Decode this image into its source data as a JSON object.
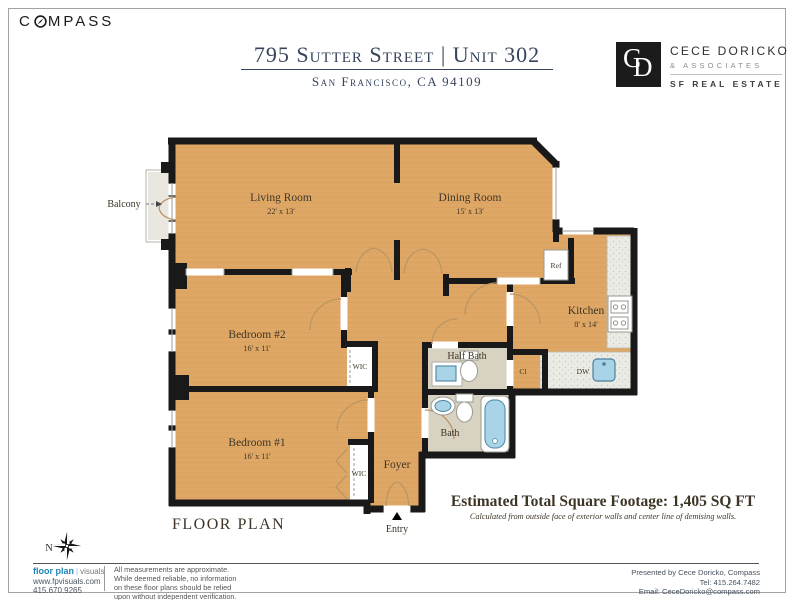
{
  "header": {
    "brand_prefix": "C",
    "brand_suffix": "MPASS",
    "title": "795 Sutter Street  |  Unit 302",
    "subtitle": "San Francisco, CA 94109",
    "agent": {
      "monogram_c": "C",
      "monogram_d": "D",
      "name": "CECE DORICKO",
      "assoc": "& ASSOCIATES",
      "brand": "SF REAL ESTATE"
    }
  },
  "plan": {
    "rooms": [
      {
        "name": "Living Room",
        "dims": "22' x 13'"
      },
      {
        "name": "Dining Room",
        "dims": "15' x 13'"
      },
      {
        "name": "Bedroom #2",
        "dims": "16' x 11'"
      },
      {
        "name": "Bedroom #1",
        "dims": "16' x 11'"
      },
      {
        "name": "Kitchen",
        "dims": "8' x 14'"
      },
      {
        "name": "Half Bath"
      },
      {
        "name": "Bath"
      },
      {
        "name": "Foyer"
      }
    ],
    "features": {
      "wic": "WIC",
      "closet": "Cl",
      "ref": "Ref",
      "dw": "DW",
      "balcony": "Balcony",
      "entry": "Entry",
      "north": "N"
    },
    "caption": "FLOOR PLAN",
    "sqft_line": "Estimated Total Square Footage: 1,405 SQ FT",
    "sqft_note": "Calculated from outside face of exterior walls and center line of demising walls."
  },
  "footer": {
    "fp_logo": {
      "bold": "floor plan",
      "light": "visuals",
      "url": "www.fpvisuals.com",
      "phone": "415.670.9265"
    },
    "disclaimer": [
      "All measurements are approximate.",
      "While deemed reliable, no information",
      "on these floor plans should be relied",
      "upon without independent verification."
    ],
    "presented": [
      "Presented by Cece Doricko, Compass",
      "Tel: 415.264.7482",
      "Email: CeceDoricko@compass.com"
    ]
  },
  "colors": {
    "accent_navy": "#36455c",
    "floor_tan": "#dfa765",
    "wall": "#191919",
    "fixture_blue": "#a9d3e6",
    "fp_logo_blue": "#1b86b8"
  }
}
